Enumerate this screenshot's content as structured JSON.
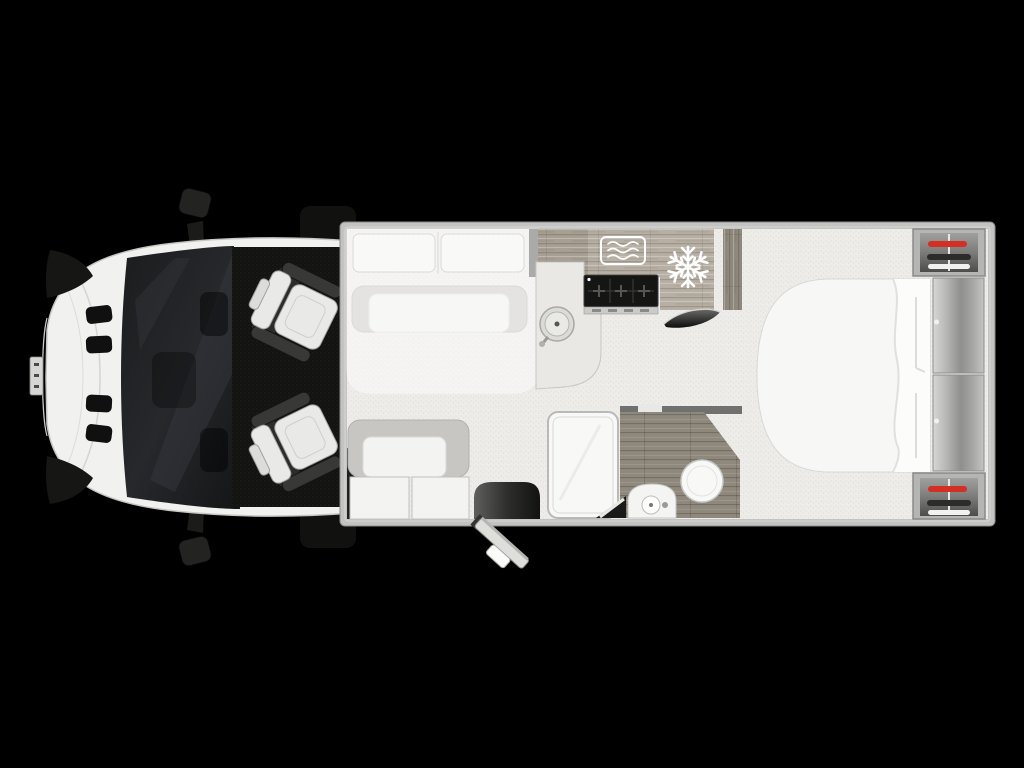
{
  "scene": {
    "type": "motorhome-floorplan-top-view",
    "description": "Top-down floor plan of a motorhome: front cab with two swivel seats, front lounge with drop-down bed over U-sofa, side sofa, kitchen with sink, hob, microwave and fridge, central bathroom with shower, washbasin and toilet, rear island bed with headboard cabinets and twin wardrobes with hangers",
    "background": "#000000"
  },
  "colors": {
    "background": "#000000",
    "floor": "#edecE9",
    "wall": "#c3c3c1",
    "sofa_gray": "#c7c6c3",
    "cushion_white": "#f3f3f1",
    "wood_light": "#b7afa4",
    "wood_mid": "#a89f93",
    "wood_dark": "#8f887c",
    "hob_black": "#151513",
    "fixture_white": "#f8f8f6",
    "cab_body_white": "#f1f1ef",
    "seat_white": "#e9e9e7",
    "hanger_red": "#d32f23",
    "hanger_dark": "#2c2c2a",
    "hanger_white": "#f2f2f0",
    "icon_white": "#ffffff",
    "windshield_dark": "#1d1e21",
    "cab_floor_black": "#131311"
  },
  "rooms": [
    {
      "name": "cab",
      "fixtures": [
        "driver-swivel-seat",
        "passenger-swivel-seat",
        "left-mirror",
        "right-mirror",
        "windshield"
      ]
    },
    {
      "name": "front-lounge",
      "fixtures": [
        "u-shaped-sofa",
        "drop-down-bed-with-pillows",
        "side-sofa",
        "entrance-step",
        "entrance-door-open"
      ]
    },
    {
      "name": "kitchen",
      "fixtures": [
        "round-sink-with-tap",
        "three-burner-hob",
        "microwave-oven",
        "fridge-freezer",
        "tall-cupboard"
      ]
    },
    {
      "name": "bathroom",
      "fixtures": [
        "shower-tray",
        "washbasin-vanity",
        "toilet",
        "wood-floor",
        "pivot-door"
      ]
    },
    {
      "name": "rear-bedroom",
      "fixtures": [
        "island-bed",
        "headboard-cabinet-upper",
        "headboard-cabinet-lower",
        "wardrobe-offside",
        "wardrobe-nearside"
      ]
    }
  ],
  "icons": {
    "microwave": "microwave-waves-icon",
    "fridge": "snowflake-icon",
    "wardrobe_hangers": [
      "red-hanger",
      "dark-hanger",
      "white-hanger"
    ]
  }
}
